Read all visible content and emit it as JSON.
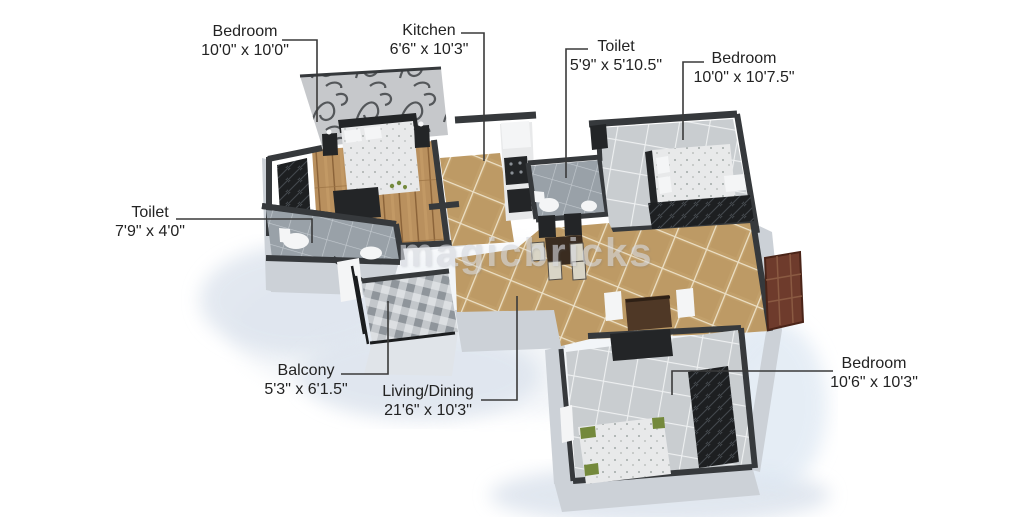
{
  "watermark": {
    "text": "magicbricks"
  },
  "labels": [
    {
      "name": "Bedroom",
      "dims": "10'0\" x 10'0\""
    },
    {
      "name": "Kitchen",
      "dims": "6'6\" x 10'3\""
    },
    {
      "name": "Toilet",
      "dims": "5'9\" x 5'10.5\""
    },
    {
      "name": "Bedroom",
      "dims": "10'0\" x 10'7.5\""
    },
    {
      "name": "Toilet",
      "dims": "7'9\" x 4'0\""
    },
    {
      "name": "Balcony",
      "dims": "5'3\" x 6'1.5\""
    },
    {
      "name": "Living/Dining",
      "dims": "21'6\" x 10'3\""
    },
    {
      "name": "Bedroom",
      "dims": "10'6\" x 10'3\""
    }
  ],
  "colors": {
    "background": "#ffffff",
    "label_text": "#232323",
    "leader_line": "#3a3a3a",
    "wall_dark": "#36393c",
    "wall_light": "#ccd1d7",
    "floor_wood": "#b9905e",
    "floor_tile_tan": "#c2a06b",
    "floor_tile_gray": "#99a1a8",
    "floor_tile_light": "#c9cdd0",
    "grout": "#ece0c6",
    "furniture_dark": "#232527",
    "bed_white": "#e8e9ea",
    "door_brown": "#6e3b2c",
    "bench_wood": "#4f3826",
    "accent_green": "#74893c",
    "shadow": "#dce3ed",
    "watermark": "#d5d8de"
  }
}
